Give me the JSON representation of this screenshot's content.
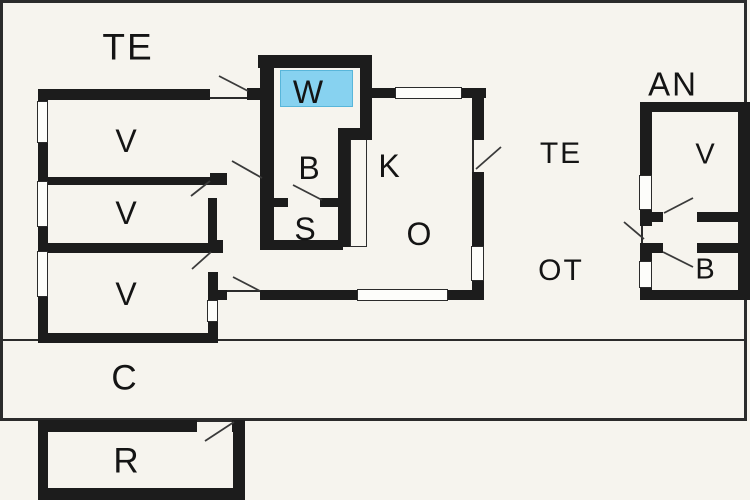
{
  "canvas": {
    "width": 750,
    "height": 500
  },
  "colors": {
    "background": "#f6f4ee",
    "wall": "#1c1c1c",
    "border": "#2b2b2b",
    "swing_line": "#3a3a3a",
    "highlight_fill": "#87d2f0",
    "highlight_border": "#58b6da"
  },
  "floorplan": {
    "labels": [
      {
        "id": "te-top",
        "text": "TE",
        "x": 128,
        "y": 47,
        "size": 37
      },
      {
        "id": "v1",
        "text": "V",
        "x": 127,
        "y": 141,
        "size": 32
      },
      {
        "id": "v2",
        "text": "V",
        "x": 127,
        "y": 213,
        "size": 32
      },
      {
        "id": "v3",
        "text": "V",
        "x": 127,
        "y": 294,
        "size": 32
      },
      {
        "id": "w",
        "text": "W",
        "x": 309,
        "y": 92,
        "size": 32
      },
      {
        "id": "b",
        "text": "B",
        "x": 310,
        "y": 168,
        "size": 32
      },
      {
        "id": "s",
        "text": "S",
        "x": 306,
        "y": 229,
        "size": 32
      },
      {
        "id": "k",
        "text": "K",
        "x": 390,
        "y": 166,
        "size": 32
      },
      {
        "id": "o",
        "text": "O",
        "x": 420,
        "y": 234,
        "size": 32
      },
      {
        "id": "te-right",
        "text": "TE",
        "x": 561,
        "y": 154,
        "size": 30
      },
      {
        "id": "ot",
        "text": "OT",
        "x": 561,
        "y": 271,
        "size": 30
      },
      {
        "id": "an",
        "text": "AN",
        "x": 673,
        "y": 84,
        "size": 33
      },
      {
        "id": "v-annex",
        "text": "V",
        "x": 706,
        "y": 155,
        "size": 29
      },
      {
        "id": "b-annex",
        "text": "B",
        "x": 706,
        "y": 270,
        "size": 29
      },
      {
        "id": "c",
        "text": "C",
        "x": 125,
        "y": 378,
        "size": 35
      },
      {
        "id": "r",
        "text": "R",
        "x": 127,
        "y": 461,
        "size": 35
      }
    ],
    "border_frame": [
      0,
      0,
      747,
      421
    ],
    "walls": [
      [
        38,
        89,
        172,
        11
      ],
      [
        247,
        88,
        27,
        12
      ],
      [
        38,
        89,
        10,
        254
      ],
      [
        48,
        177,
        179,
        8
      ],
      [
        210,
        173,
        17,
        12
      ],
      [
        48,
        243,
        162,
        10
      ],
      [
        210,
        240,
        13,
        13
      ],
      [
        208,
        198,
        9,
        45
      ],
      [
        208,
        272,
        10,
        28
      ],
      [
        208,
        322,
        10,
        21
      ],
      [
        38,
        333,
        180,
        10
      ],
      [
        218,
        290,
        9,
        10
      ],
      [
        258,
        55,
        112,
        13
      ],
      [
        260,
        55,
        14,
        195
      ],
      [
        360,
        55,
        12,
        85
      ],
      [
        338,
        128,
        34,
        12
      ],
      [
        338,
        128,
        12,
        119
      ],
      [
        274,
        198,
        14,
        9
      ],
      [
        320,
        198,
        18,
        9
      ],
      [
        260,
        240,
        83,
        10
      ],
      [
        372,
        88,
        114,
        10
      ],
      [
        472,
        88,
        12,
        52
      ],
      [
        472,
        172,
        12,
        75
      ],
      [
        472,
        280,
        12,
        20
      ],
      [
        260,
        290,
        97,
        10
      ],
      [
        448,
        290,
        36,
        10
      ],
      [
        640,
        102,
        110,
        10
      ],
      [
        640,
        102,
        12,
        73
      ],
      [
        640,
        210,
        12,
        16
      ],
      [
        640,
        243,
        12,
        18
      ],
      [
        640,
        287,
        12,
        13
      ],
      [
        738,
        102,
        12,
        198
      ],
      [
        652,
        212,
        11,
        10
      ],
      [
        697,
        212,
        46,
        10
      ],
      [
        652,
        243,
        11,
        10
      ],
      [
        697,
        243,
        46,
        10
      ],
      [
        640,
        290,
        110,
        10
      ],
      [
        38,
        420,
        159,
        12
      ],
      [
        232,
        420,
        13,
        12
      ],
      [
        38,
        420,
        10,
        80
      ],
      [
        233,
        420,
        12,
        80
      ],
      [
        38,
        488,
        207,
        12
      ]
    ],
    "windows": [
      [
        37,
        101,
        11,
        42
      ],
      [
        37,
        181,
        11,
        46
      ],
      [
        37,
        251,
        11,
        46
      ],
      [
        207,
        300,
        11,
        22
      ],
      [
        395,
        87,
        67,
        12
      ],
      [
        471,
        246,
        13,
        35
      ],
      [
        357,
        289,
        91,
        12
      ],
      [
        639,
        175,
        13,
        35
      ],
      [
        639,
        261,
        13,
        27
      ]
    ],
    "fixtures": [
      [
        350,
        130,
        17,
        117
      ]
    ],
    "thin_lines": [
      [
        3,
        339,
        743,
        2
      ],
      [
        3,
        419,
        743,
        2
      ],
      [
        210,
        97,
        37,
        2
      ],
      [
        227,
        290,
        33,
        2
      ],
      [
        472,
        140,
        2,
        32
      ],
      [
        641,
        226,
        2,
        17
      ],
      [
        197,
        420,
        35,
        2
      ]
    ],
    "door_swings": [
      [
        219,
        76,
        248,
        91
      ],
      [
        232,
        161,
        262,
        178
      ],
      [
        191,
        196,
        210,
        181
      ],
      [
        192,
        269,
        211,
        252
      ],
      [
        233,
        277,
        260,
        291
      ],
      [
        293,
        185,
        322,
        200
      ],
      [
        476,
        169,
        501,
        147
      ],
      [
        664,
        213,
        693,
        198
      ],
      [
        624,
        222,
        644,
        239
      ],
      [
        663,
        252,
        693,
        267
      ],
      [
        205,
        441,
        234,
        422
      ]
    ],
    "highlight_rect": [
      280,
      70,
      73,
      37
    ]
  }
}
